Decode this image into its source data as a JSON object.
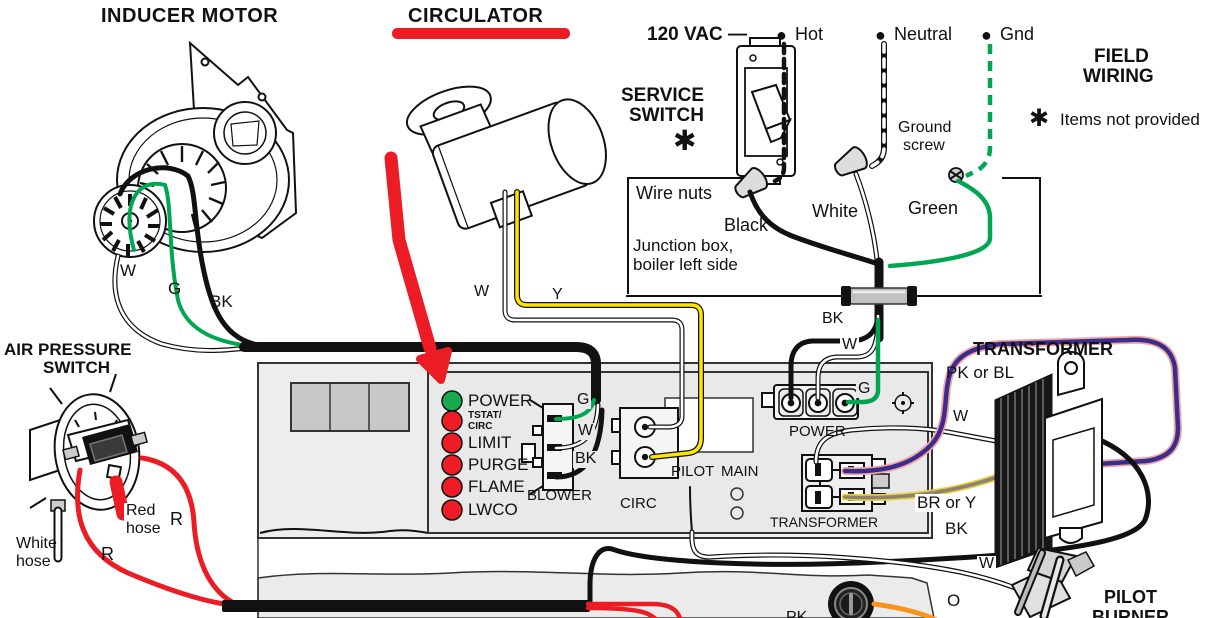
{
  "titles": {
    "inducer_motor": "INDUCER MOTOR",
    "circulator": "CIRCULATOR",
    "service_line1": "SERVICE",
    "service_line2": "SWITCH",
    "field_line1": "FIELD",
    "field_line2": "WIRING",
    "aps_line1": "AIR PRESSURE",
    "aps_line2": "SWITCH",
    "transformer": "TRANSFORMER",
    "pilot_line1": "PILOT",
    "pilot_line2": "BURNER"
  },
  "glyphs": {
    "bullet": "●",
    "star": "✱"
  },
  "power_feed": {
    "voltage": "120 VAC —",
    "hot": "Hot",
    "neutral": "Neutral",
    "gnd": "Gnd"
  },
  "legend": {
    "items_not_provided": "Items not provided"
  },
  "junction_box": {
    "wire_nuts": "Wire nuts",
    "black": "Black",
    "white": "White",
    "green": "Green",
    "caption_line1": "Junction box,",
    "caption_line2": "boiler left side",
    "ground_line1": "Ground",
    "ground_line2": "screw",
    "bk": "BK",
    "w": "W"
  },
  "board": {
    "leds": [
      {
        "label": "POWER",
        "color": "green"
      },
      {
        "label_line1": "TSTAT/",
        "label_line2": "CIRC",
        "color": "red"
      },
      {
        "label": "LIMIT",
        "color": "red"
      },
      {
        "label": "PURGE",
        "color": "red"
      },
      {
        "label": "FLAME",
        "color": "red"
      },
      {
        "label": "LWCO",
        "color": "red"
      }
    ],
    "blower": "BLOWER",
    "circ": "CIRC",
    "pilot": "PILOT",
    "main": "MAIN",
    "power": "POWER",
    "transformer": "TRANSFORMER",
    "blower_pins": {
      "g": "G",
      "w": "W",
      "bk": "BK"
    },
    "power_g": "G"
  },
  "inducer_wires": {
    "w": "W",
    "g": "G",
    "bk": "BK"
  },
  "circulator_wires": {
    "w": "W",
    "y": "Y"
  },
  "transformer_labels": {
    "pk_or_bl": "PK or BL",
    "w": "W",
    "br_or_y": "BR or Y",
    "bk": "BK"
  },
  "aps": {
    "red_hose_line1": "Red",
    "red_hose_line2": "hose",
    "white_hose_line1": "White",
    "white_hose_line2": "hose",
    "r_upper": "R",
    "r_lower": "R"
  },
  "bottom": {
    "o": "O",
    "w": "W",
    "pk": "PK"
  },
  "colors": {
    "wire_red": "#ec1c24",
    "wire_green": "#00a651",
    "wire_yellow": "#ffe600",
    "wire_orange": "#f7941d",
    "wire_purple": "#3a2d8f",
    "wire_pink_edge": "#f2a7a2",
    "wire_olive": "#8d8273",
    "led_green": "#17a94d",
    "led_red": "#ee1c25",
    "board_bg": "#e9e9e9",
    "jacket_bg": "#ededed",
    "arrow_red": "#ec1c24"
  }
}
